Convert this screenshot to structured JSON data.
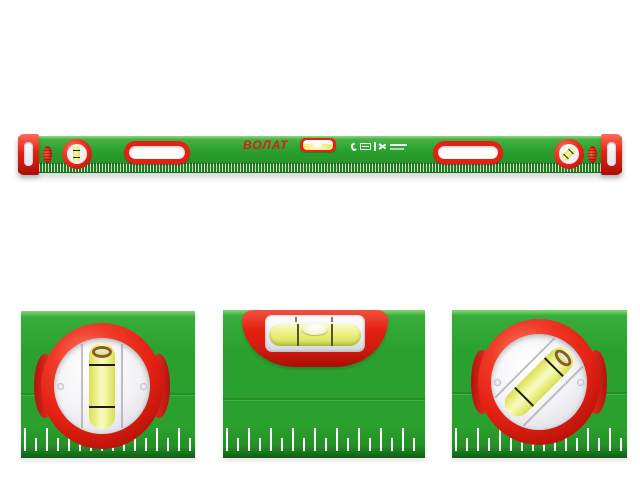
{
  "brand": {
    "name": "ВОЛАТ"
  },
  "product": {
    "kind": "box-section spirit level with three vials"
  },
  "marking_icons": [
    "handset-icon",
    "spec-box-icon",
    "divider-icon",
    "angle-marks-icon"
  ],
  "palette": {
    "green_main": "#2aa12e",
    "green_light": "#83d673",
    "green_dark": "#1e7e22",
    "green_edge": "#125c16",
    "red_main": "#e42113",
    "red_dark": "#a90e06",
    "red_light": "#ff6f5c",
    "brand_red": "#d3201a",
    "vial_yellow": "#eef292",
    "vial_yellow_deep": "#d8df52",
    "vial_yellow_pale": "#f8fbc4",
    "silver": "#f2f2f5",
    "bubble_ring_brown": "#8d5c26",
    "tick_white": "#ffffff"
  }
}
